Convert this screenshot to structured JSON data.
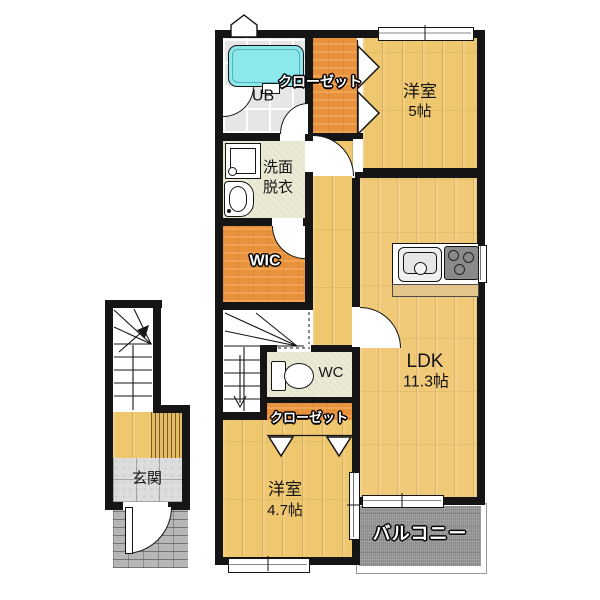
{
  "rooms": {
    "ub": {
      "label": "UB"
    },
    "closet_upper": {
      "label": "クローゼット"
    },
    "bedroom5": {
      "name": "洋室",
      "size": "5帖"
    },
    "washroom": {
      "line1": "洗面",
      "line2": "脱衣"
    },
    "wic": {
      "label": "WIC"
    },
    "ldk": {
      "name": "LDK",
      "size": "11.3帖"
    },
    "wc": {
      "label": "WC"
    },
    "closet_lower": {
      "label": "クローゼット"
    },
    "bedroom47": {
      "name": "洋室",
      "size": "4.7帖"
    },
    "balcony": {
      "label": "バルコニー"
    },
    "genkan": {
      "label": "玄関"
    }
  },
  "colors": {
    "wall": "#151515",
    "wood_floor": "#eec76f",
    "closet_orange": "#e9923e",
    "service_floor": "#ebead4",
    "bathtub_cyan": "#8de8ec",
    "balcony_gray": "#9b9b9b"
  }
}
